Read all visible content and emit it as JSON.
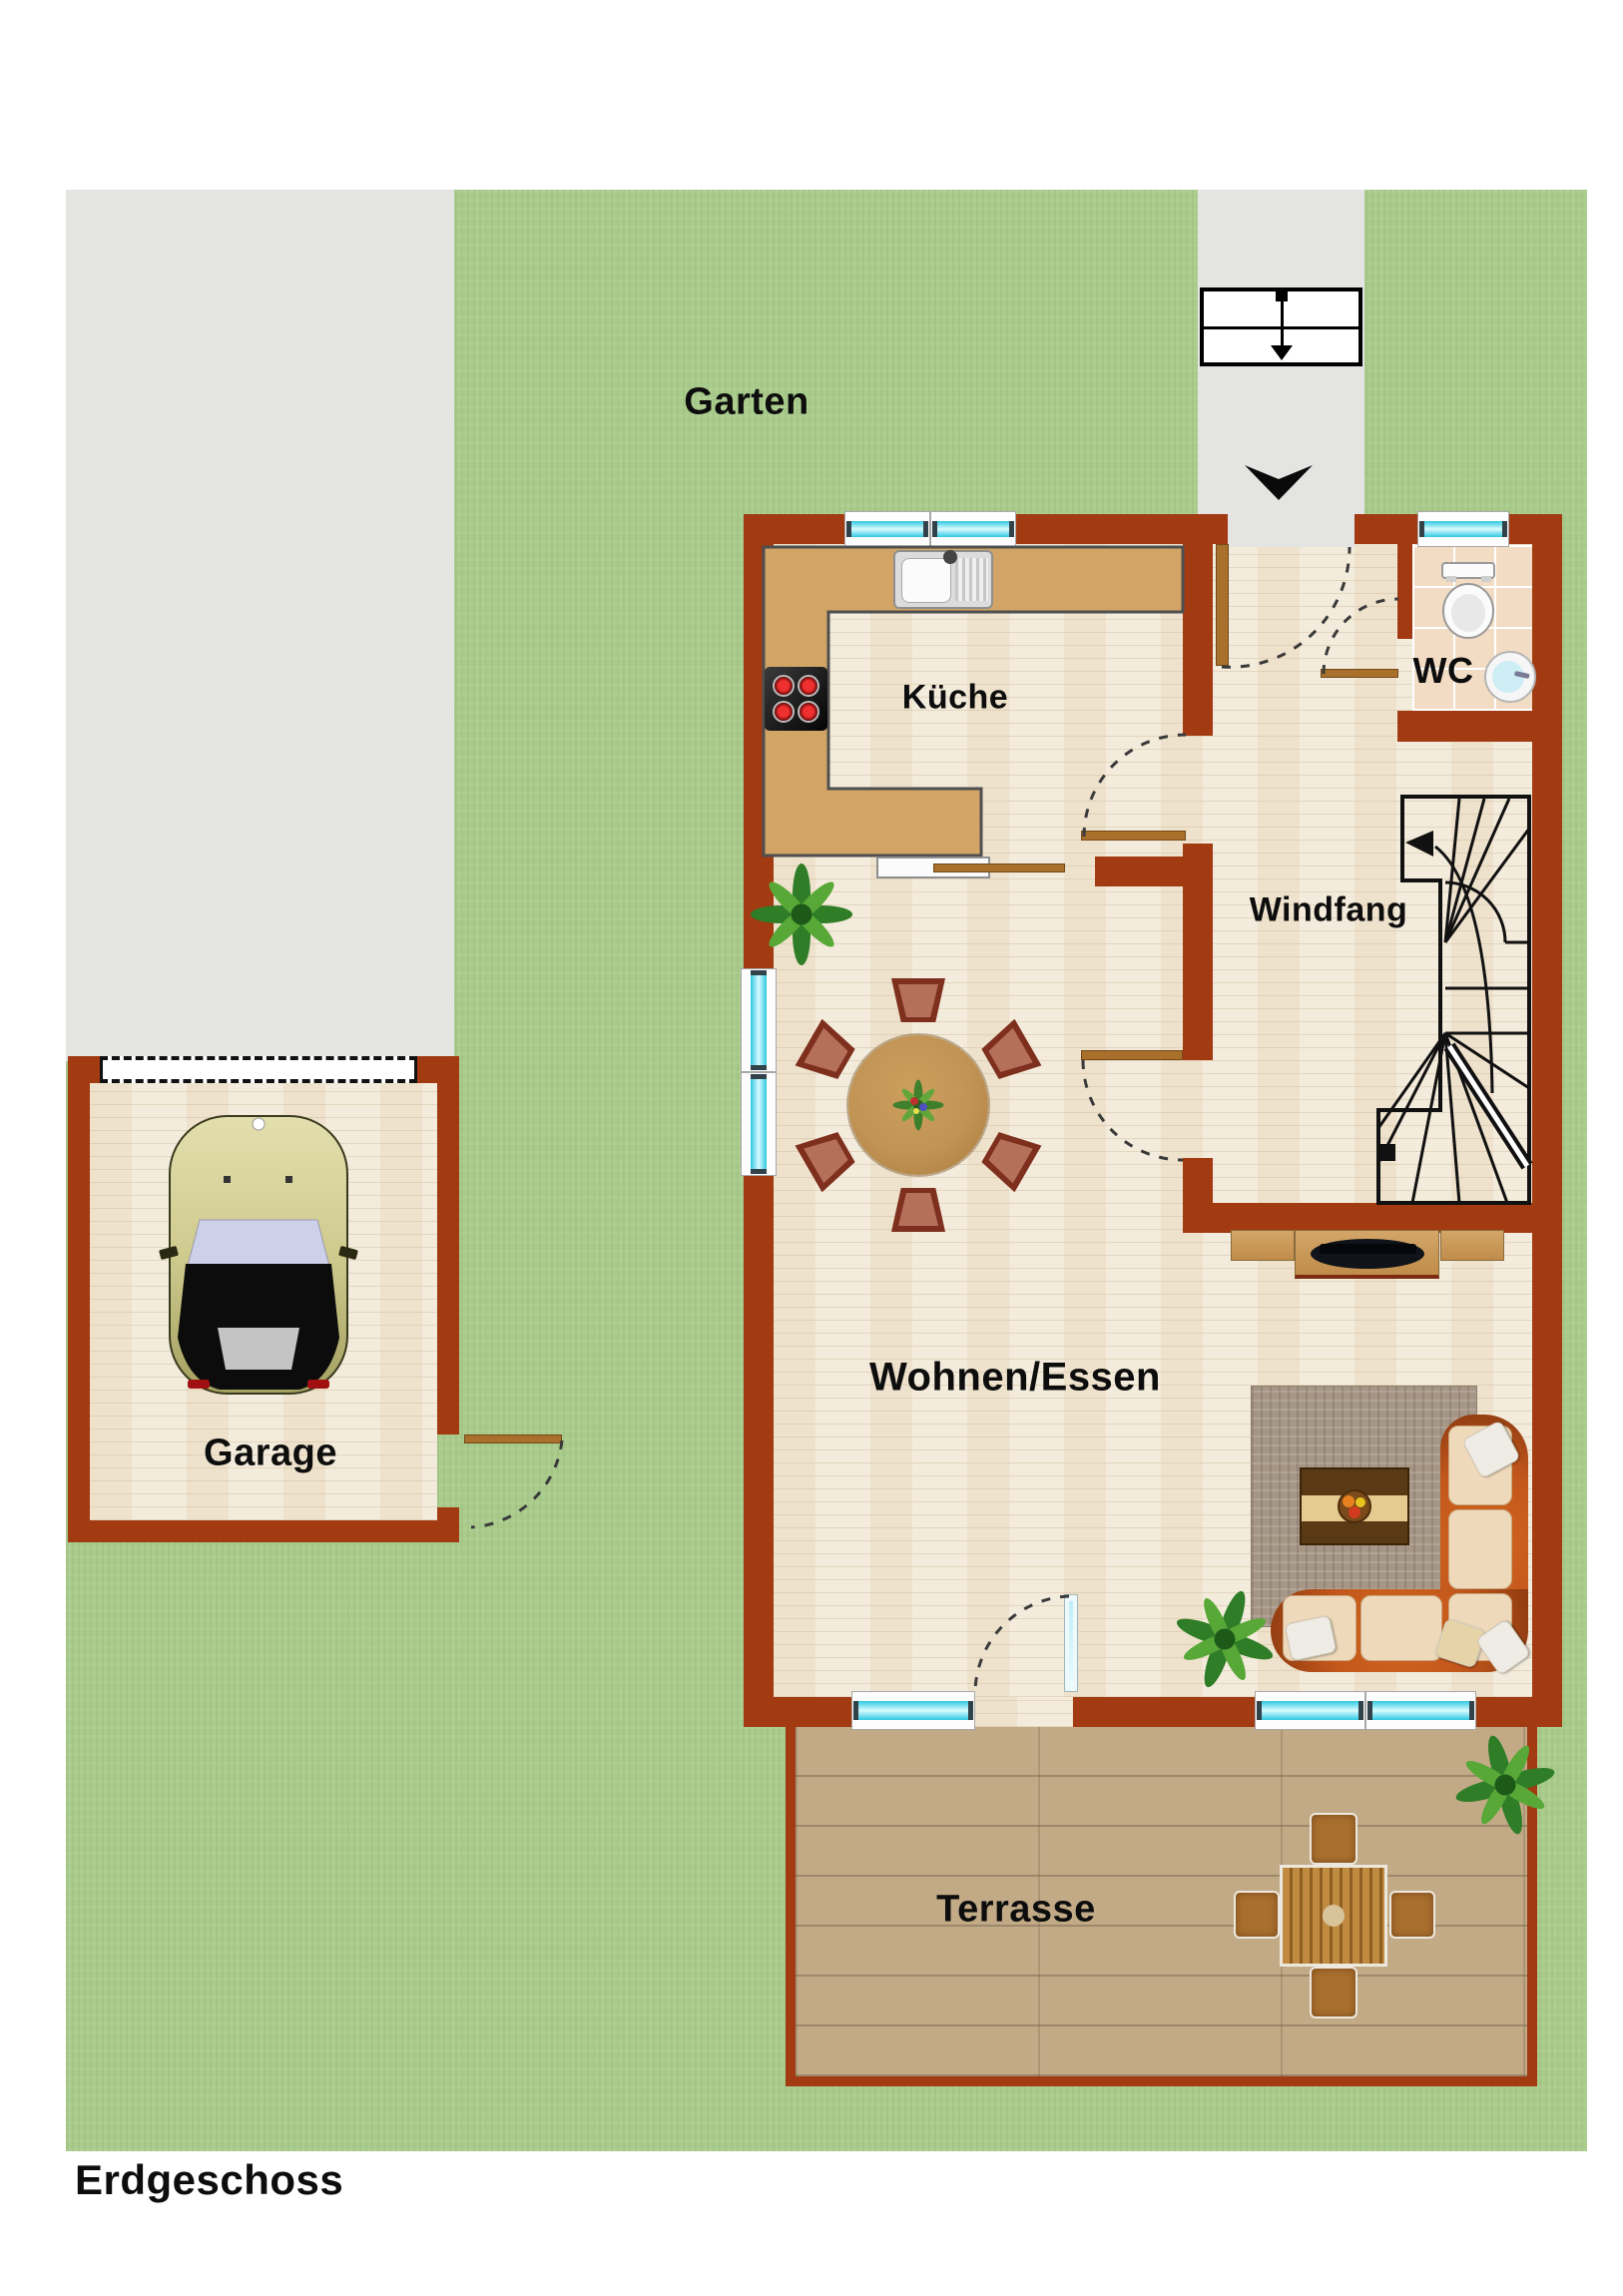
{
  "title": "Erdgeschoss",
  "labels": {
    "garten": "Garten",
    "kueche": "Küche",
    "wc": "WC",
    "windfang": "Windfang",
    "wohnen_essen": "Wohnen/Essen",
    "garage": "Garage",
    "terrasse": "Terrasse",
    "erdgeschoss": "Erdgeschoss"
  },
  "colors": {
    "wall": "#a23a12",
    "grass": "#a9cb8b",
    "driveway": "#e4e4e2",
    "parquet_floor": "#f3ebdb",
    "kitchen_counter": "#d2a466",
    "wc_tiles": "#f2dcc4",
    "terrace_deck": "#c2aa87",
    "window_glass": "#7ceaf8",
    "sofa": "#c2571c",
    "rug": "#a69686",
    "door_wood": "#a9702c",
    "dining_table": "#c19355",
    "label_text": "#0d0d0d"
  }
}
